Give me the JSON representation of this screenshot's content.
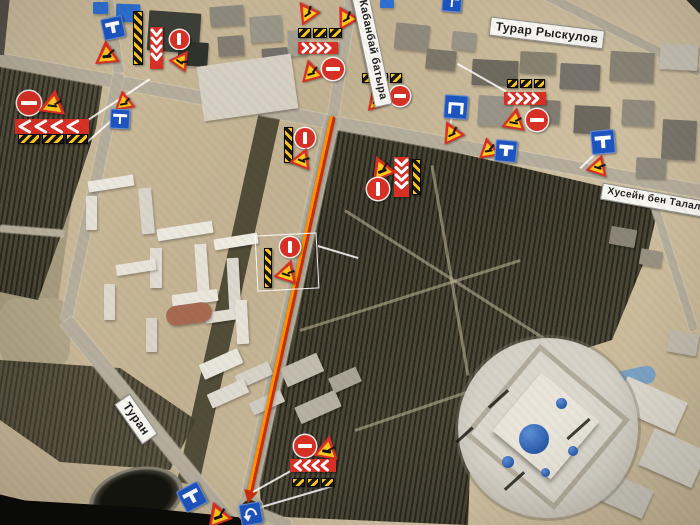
{
  "map": {
    "colors": {
      "sign_red": "#d93025",
      "sign_yellow": "#ffc81e",
      "sign_blue": "#1d55c0",
      "route_red": "#c92f08",
      "route_orange": "#ff9100",
      "label_bg": "#f8f6f0",
      "label_text": "#1f1f1f"
    },
    "street_labels": [
      {
        "text": "Кабанбай батыра",
        "x": 372,
        "y": 50,
        "r": 78,
        "fs": 11
      },
      {
        "text": "Турар Рыскулов",
        "x": 547,
        "y": 33,
        "r": 7,
        "fs": 12
      },
      {
        "text": "Хусейн бен Талал",
        "x": 654,
        "y": 200,
        "r": 10,
        "fs": 10
      },
      {
        "text": "Туран",
        "x": 136,
        "y": 419,
        "r": 55,
        "fs": 12
      }
    ],
    "construction_route": {
      "x1": 333,
      "y1": 116,
      "x2": 249,
      "y2": 497
    },
    "highlight_box": {
      "x": 256,
      "y": 234,
      "w": 62,
      "h": 56,
      "r": -3
    },
    "leader_lines": [
      {
        "x1": 88,
        "y1": 120,
        "x2": 150,
        "y2": 79
      },
      {
        "x1": 86,
        "y1": 143,
        "x2": 121,
        "y2": 112
      },
      {
        "x1": 318,
        "y1": 246,
        "x2": 358,
        "y2": 258
      },
      {
        "x1": 253,
        "y1": 492,
        "x2": 296,
        "y2": 468
      },
      {
        "x1": 258,
        "y1": 508,
        "x2": 333,
        "y2": 486
      },
      {
        "x1": 597,
        "y1": 153,
        "x2": 580,
        "y2": 169
      },
      {
        "x1": 506,
        "y1": 92,
        "x2": 457,
        "y2": 64
      },
      {
        "x1": 452,
        "y1": 119,
        "x2": 447,
        "y2": 139
      }
    ],
    "signs": [
      {
        "t": "no-entry-h",
        "x": 29,
        "y": 103,
        "s": 24
      },
      {
        "t": "road-work",
        "x": 53,
        "y": 101,
        "s": 27,
        "r": 8
      },
      {
        "t": "chevron-left",
        "x": 52,
        "y": 126,
        "w": 74,
        "h": 15
      },
      {
        "t": "hatch-row",
        "x": 53,
        "y": 139,
        "w": 70,
        "h": 10
      },
      {
        "t": "dead-end",
        "x": 113,
        "y": 28,
        "s": 22,
        "r": -12
      },
      {
        "t": "road-work",
        "x": 106,
        "y": 51,
        "s": 25,
        "r": -5
      },
      {
        "t": "hatch-bar",
        "x": 138,
        "y": 38,
        "w": 10,
        "h": 54
      },
      {
        "t": "chevron-down",
        "x": 156,
        "y": 48,
        "w": 13,
        "h": 42
      },
      {
        "t": "no-entry-v",
        "x": 179,
        "y": 39,
        "s": 19
      },
      {
        "t": "road-work",
        "x": 182,
        "y": 58,
        "s": 21,
        "r": 35
      },
      {
        "t": "road-work",
        "x": 123,
        "y": 99,
        "s": 21,
        "r": -10
      },
      {
        "t": "dead-end",
        "x": 120,
        "y": 119,
        "s": 20,
        "r": 3
      },
      {
        "t": "road-work",
        "x": 305,
        "y": 10,
        "s": 23,
        "r": -35
      },
      {
        "t": "road-work",
        "x": 344,
        "y": 15,
        "s": 23,
        "r": -30
      },
      {
        "t": "hatch-row",
        "x": 320,
        "y": 33,
        "w": 44,
        "h": 10
      },
      {
        "t": "chevron-right",
        "x": 318,
        "y": 48,
        "w": 40,
        "h": 12
      },
      {
        "t": "road-work",
        "x": 310,
        "y": 69,
        "s": 23,
        "r": -15
      },
      {
        "t": "no-entry-h",
        "x": 333,
        "y": 69,
        "s": 22
      },
      {
        "t": "dead-end",
        "x": 452,
        "y": 2,
        "s": 20,
        "r": 5
      },
      {
        "t": "hatch-row",
        "x": 382,
        "y": 78,
        "w": 40,
        "h": 10
      },
      {
        "t": "road-work",
        "x": 375,
        "y": 97,
        "s": 23,
        "r": -18
      },
      {
        "t": "no-entry-h",
        "x": 400,
        "y": 96,
        "s": 20
      },
      {
        "t": "detour",
        "x": 456,
        "y": 107,
        "s": 24,
        "r": 4
      },
      {
        "t": "road-work",
        "x": 450,
        "y": 130,
        "s": 23,
        "r": -25
      },
      {
        "t": "hatch-row",
        "x": 526,
        "y": 83,
        "w": 38,
        "h": 9
      },
      {
        "t": "chevron-right",
        "x": 525,
        "y": 98,
        "w": 42,
        "h": 13
      },
      {
        "t": "road-work",
        "x": 515,
        "y": 118,
        "s": 24,
        "r": 10
      },
      {
        "t": "no-entry-h",
        "x": 537,
        "y": 120,
        "s": 22
      },
      {
        "t": "road-work",
        "x": 488,
        "y": 147,
        "s": 22,
        "r": -10
      },
      {
        "t": "dead-end",
        "x": 506,
        "y": 151,
        "s": 22,
        "r": 5
      },
      {
        "t": "dead-end",
        "x": 603,
        "y": 142,
        "s": 24,
        "r": -5
      },
      {
        "t": "road-work",
        "x": 599,
        "y": 164,
        "s": 22,
        "r": 18
      },
      {
        "t": "road-work",
        "x": 380,
        "y": 166,
        "s": 25,
        "r": -22
      },
      {
        "t": "chevron-down",
        "x": 401,
        "y": 177,
        "w": 15,
        "h": 40
      },
      {
        "t": "hatch-bar",
        "x": 416,
        "y": 177,
        "w": 9,
        "h": 36
      },
      {
        "t": "no-entry-v",
        "x": 378,
        "y": 189,
        "s": 22
      },
      {
        "t": "hatch-bar",
        "x": 288,
        "y": 145,
        "w": 9,
        "h": 36
      },
      {
        "t": "no-entry-v",
        "x": 305,
        "y": 138,
        "s": 20
      },
      {
        "t": "road-work",
        "x": 303,
        "y": 157,
        "s": 22,
        "r": 22
      },
      {
        "t": "hatch-bar",
        "x": 268,
        "y": 268,
        "w": 8,
        "h": 40
      },
      {
        "t": "no-entry-v",
        "x": 290,
        "y": 247,
        "s": 20
      },
      {
        "t": "road-work",
        "x": 288,
        "y": 270,
        "s": 24,
        "r": 18
      },
      {
        "t": "no-entry-h",
        "x": 305,
        "y": 446,
        "s": 22
      },
      {
        "t": "road-work",
        "x": 327,
        "y": 446,
        "s": 25,
        "r": 10
      },
      {
        "t": "chevron-left",
        "x": 313,
        "y": 465,
        "w": 46,
        "h": 13
      },
      {
        "t": "hatch-row",
        "x": 313,
        "y": 482,
        "w": 42,
        "h": 9
      },
      {
        "t": "dead-end",
        "x": 192,
        "y": 497,
        "s": 24,
        "r": -28
      },
      {
        "t": "road-work",
        "x": 217,
        "y": 512,
        "s": 26,
        "r": -20
      },
      {
        "t": "u-turn",
        "x": 251,
        "y": 514,
        "s": 22,
        "r": -10
      }
    ]
  }
}
